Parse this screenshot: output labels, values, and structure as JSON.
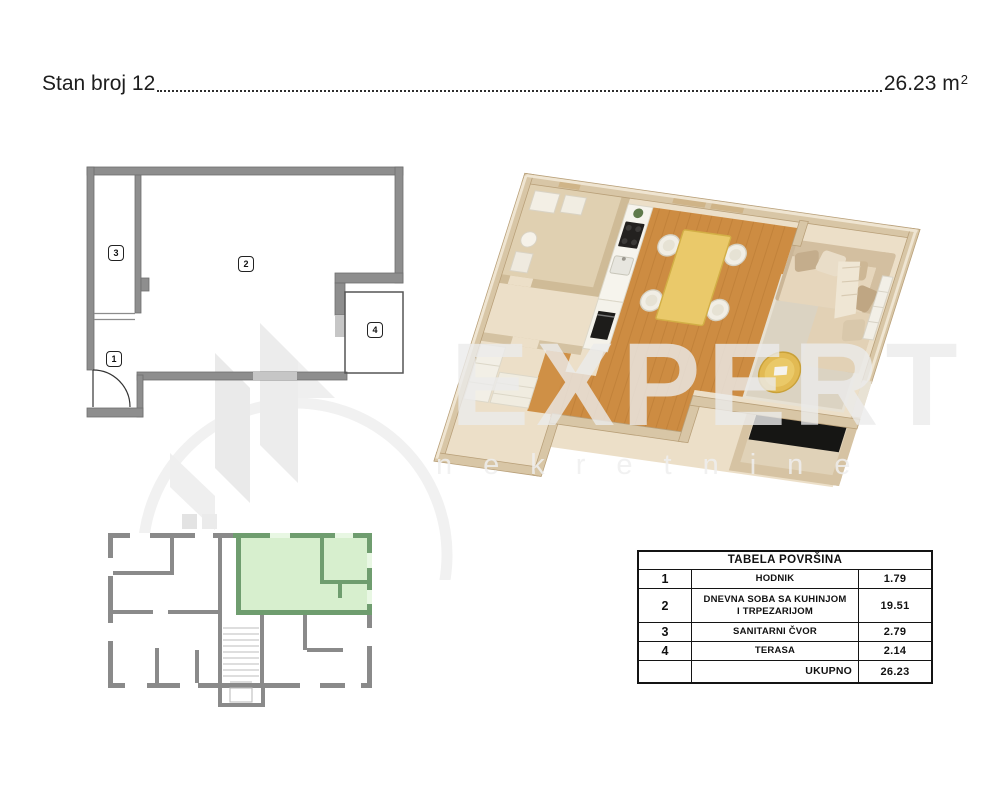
{
  "header": {
    "title": "Stan broj 12",
    "area_value": "26.23",
    "area_unit": "m",
    "area_exponent": "2"
  },
  "plan2d": {
    "labels": [
      "1",
      "2",
      "3",
      "4"
    ]
  },
  "watermark": {
    "brand": "EXPERT",
    "subbrand": "nekretnine"
  },
  "table": {
    "title": "TABELA POVRŠINA",
    "rows": [
      {
        "num": "1",
        "name": "HODNIK",
        "value": "1.79"
      },
      {
        "num": "2",
        "name": "DNEVNA SOBA SA KUHINJOM I TRPEZARIJOM",
        "value": "19.51"
      },
      {
        "num": "3",
        "name": "SANITARNI ČVOR",
        "value": "2.79"
      },
      {
        "num": "4",
        "name": "TERASA",
        "value": "2.14"
      }
    ],
    "total_label": "UKUPNO",
    "total_value": "26.23"
  },
  "colors": {
    "wall_gray": "#8c8c8c",
    "window_gray": "#c6c6c6",
    "highlight_green_fill": "#d5eecb",
    "highlight_green_wall": "#6f9d6f",
    "wood_floor": "#cd8c42",
    "wall_beige": "#d8c6a6",
    "terrace_black": "#161614",
    "watermark_gray": "#ebebeb"
  }
}
